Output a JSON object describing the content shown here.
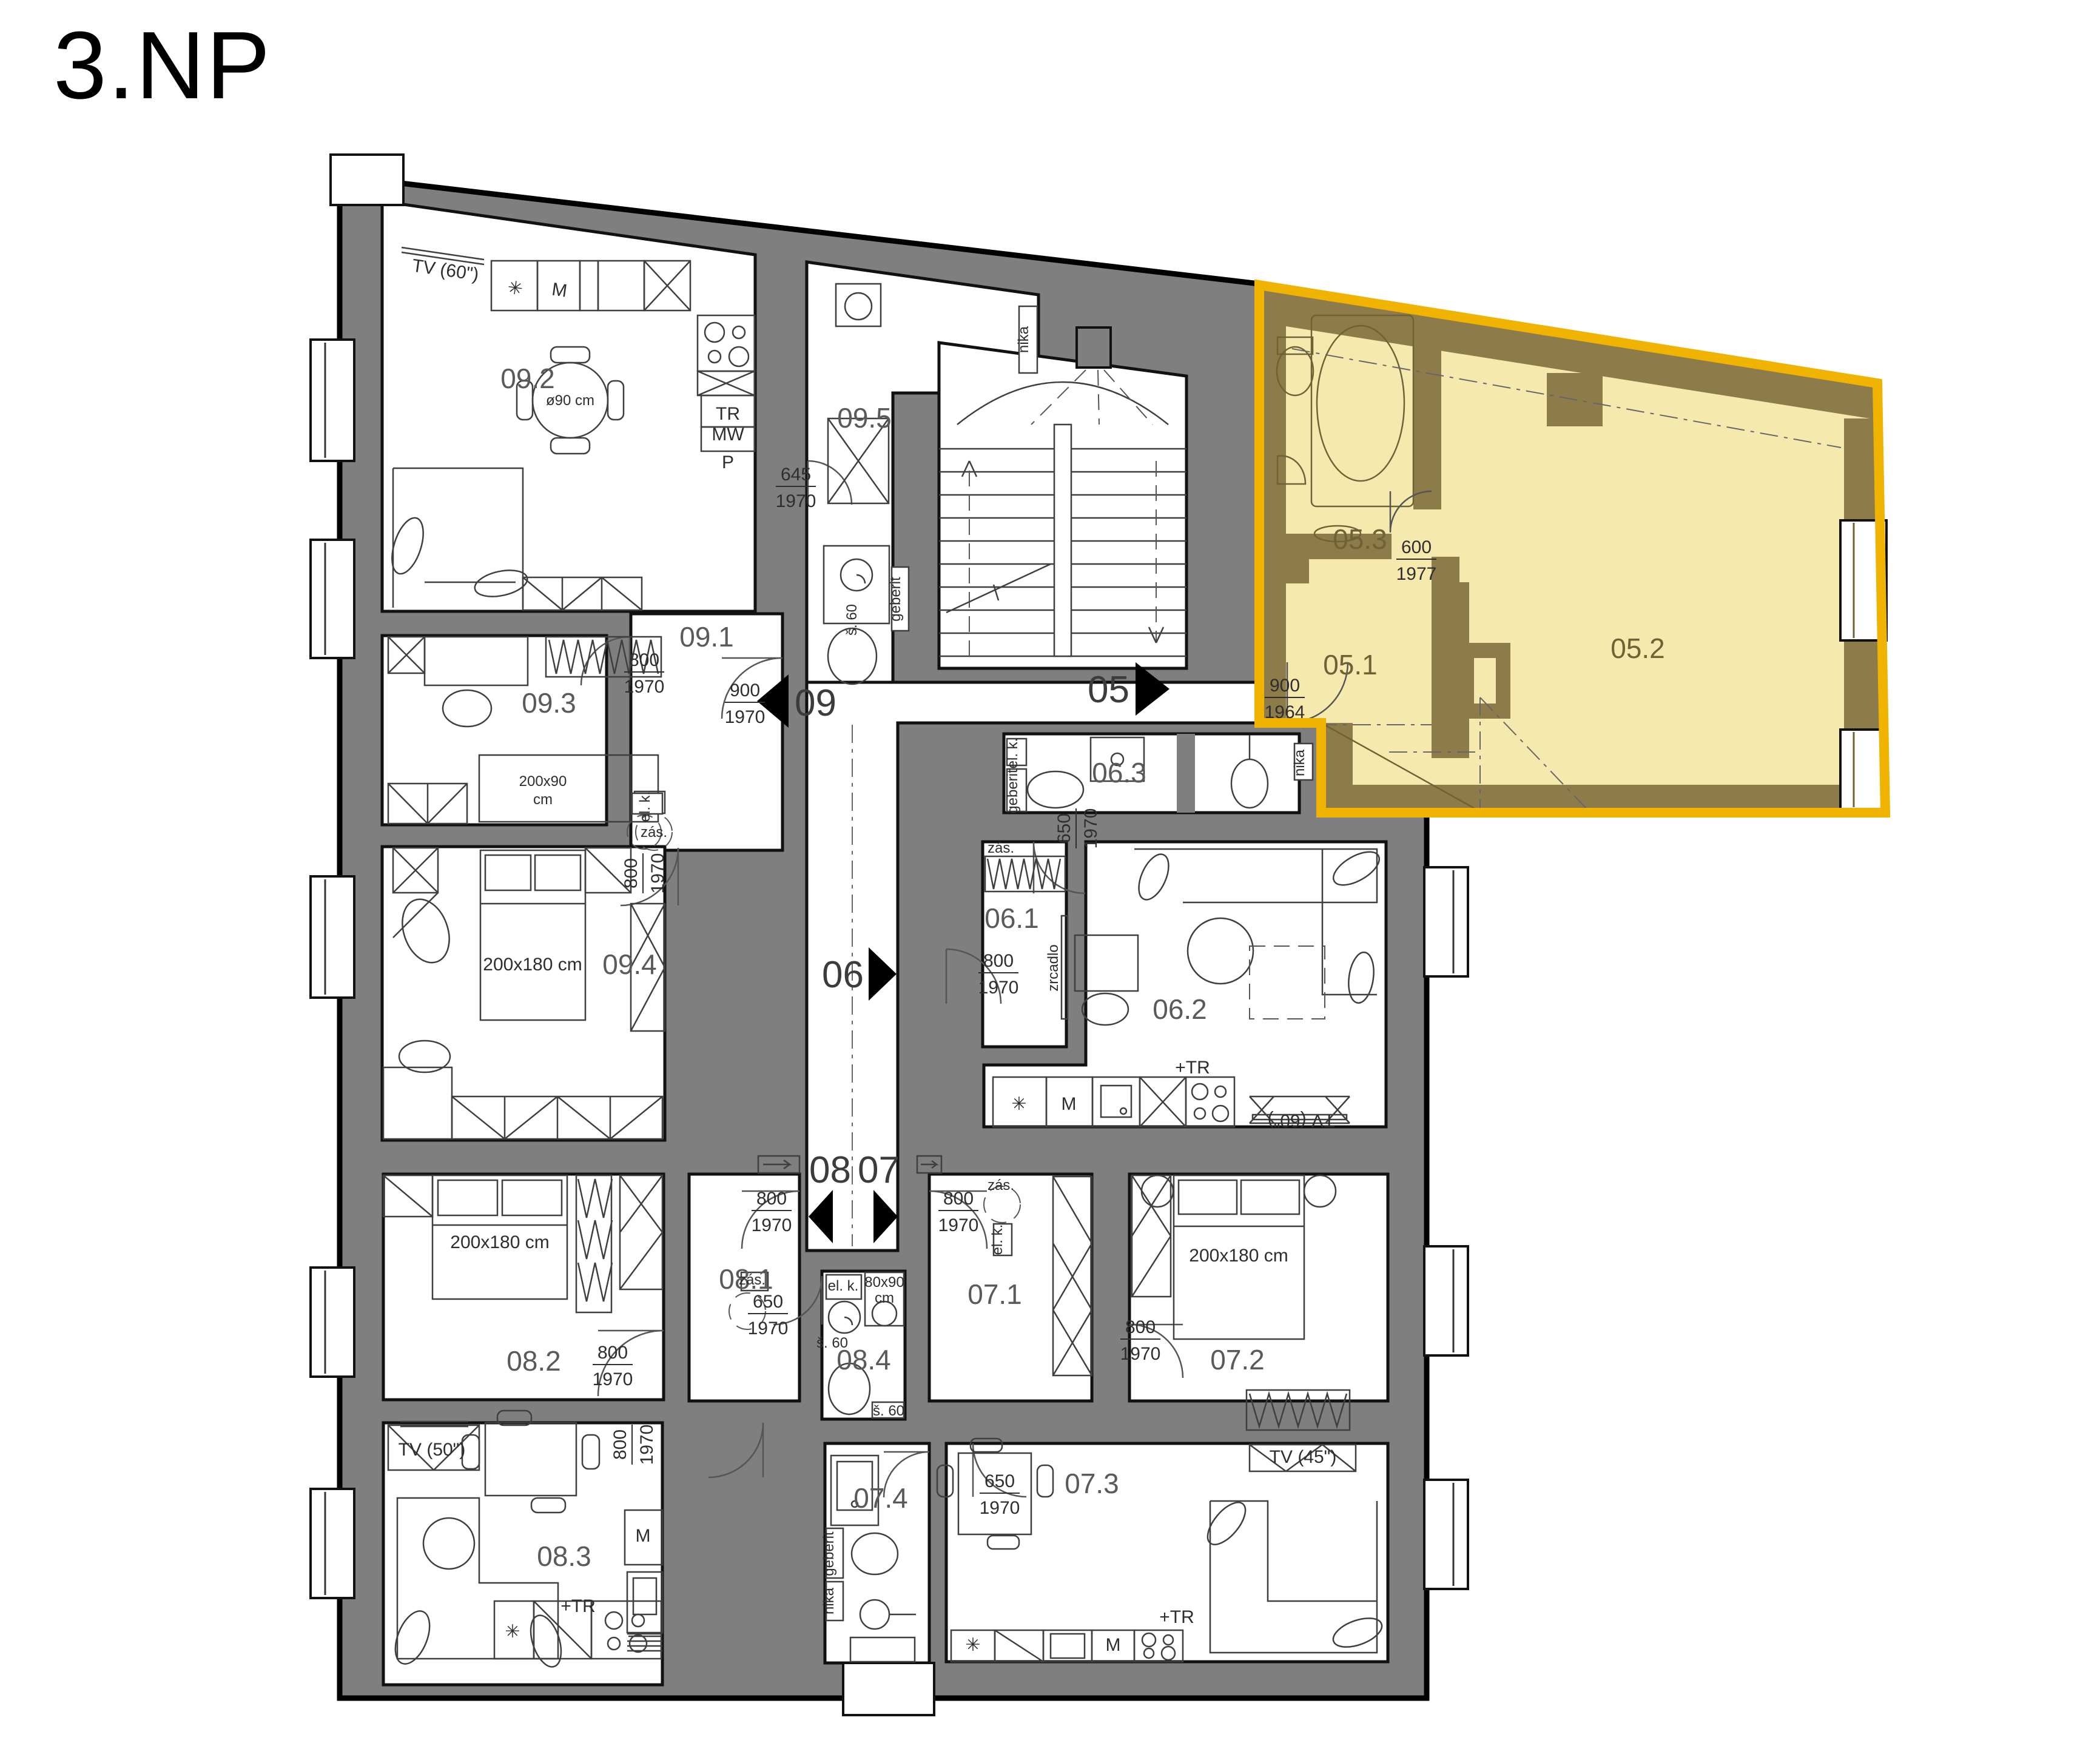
{
  "title": "3.NP",
  "colors": {
    "wall": "#7f7f7f",
    "highlight_fill": "#f6e9ae",
    "highlight_wall": "#8d7c49",
    "highlight_border": "#f0b400"
  },
  "unit_markers": {
    "u09": "09",
    "u05": "05",
    "u06": "06",
    "u08": "08",
    "u07": "07"
  },
  "rooms": {
    "r09_1": "09.1",
    "r09_2": "09.2",
    "r09_3": "09.3",
    "r09_4": "09.4",
    "r09_5": "09.5",
    "r05_1": "05.1",
    "r05_2": "05.2",
    "r05_3": "05.3",
    "r06_1": "06.1",
    "r06_2": "06.2",
    "r06_3": "06.3",
    "r07_1": "07.1",
    "r07_2": "07.2",
    "r07_3": "07.3",
    "r07_4": "07.4",
    "r08_1": "08.1",
    "r08_2": "08.2",
    "r08_3": "08.3",
    "r08_4": "08.4"
  },
  "dims": {
    "d600": "600",
    "d645": "645",
    "d650": "650",
    "d800": "800",
    "d900": "900",
    "d1964": "1964",
    "d1970": "1970",
    "d1977": "1977"
  },
  "furniture": {
    "tv60": "TV (60\")",
    "tv50": "TV (50\")",
    "tv45": "TV (45\")",
    "round_table": "ø90 cm",
    "bed_large": "200x180 cm",
    "bed_small_l1": "200x90",
    "bed_small_l2": "cm",
    "shower_l1": "80x90",
    "shower_l2": "cm",
    "tr": "TR",
    "mw": "MW",
    "p": "P",
    "m": "M",
    "plus_tr": "+TR",
    "s60": "š. 60",
    "el_k": "el. k.",
    "zas": "zás.",
    "geberit": "geberit",
    "nika": "nika",
    "zrcadlo": "zrcadlo"
  }
}
